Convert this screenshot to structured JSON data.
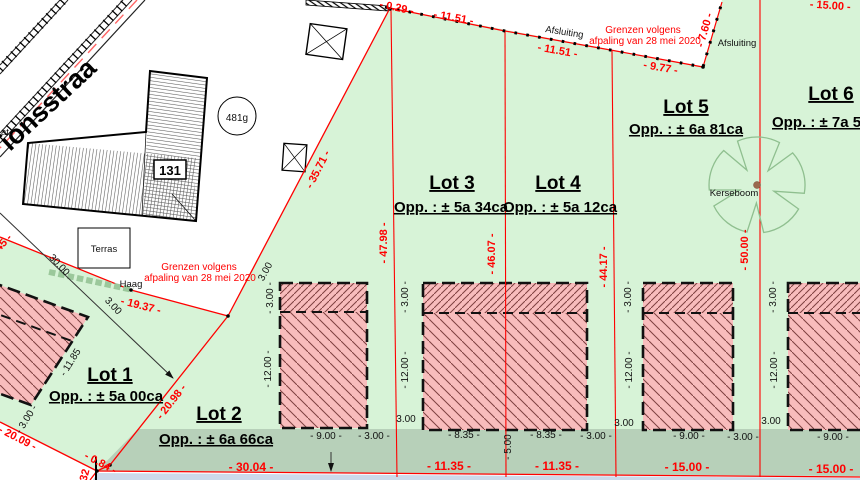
{
  "colors": {
    "lot_green": "#d7f3d7",
    "strip_green": "#b7d0b9",
    "building_pink": "#f8bcbc",
    "hatch_red": "#7d4040",
    "boundary_red": "#ff0000",
    "road_dash_red": "#ff6666",
    "pale_blue_strip": "#ccd9ea",
    "tree_green": "#8fbf8f",
    "trunk_brown": "#9a6a4e"
  },
  "street": {
    "name_fragment": "ionsstraa",
    "edge_fragment": "at."
  },
  "landmarks": {
    "house_number": "131",
    "parcel_id": "481g",
    "terrace": "Terras",
    "hedge": "Haag",
    "tree": "Kerseboom",
    "fence_top": "Afsluiting",
    "fence_right": "Afsluiting"
  },
  "notes": {
    "survey_top_line1": "Grenzen volgens",
    "survey_top_line2": "afpaling van 28 mei 2020",
    "survey_left_line1": "Grenzen volgens",
    "survey_left_line2": "afpaling van 28 mei 2020"
  },
  "lots": [
    {
      "name": "Lot 1",
      "area": "Opp. : ± 5a 00ca"
    },
    {
      "name": "Lot 2",
      "area": "Opp. : ± 6a 66ca"
    },
    {
      "name": "Lot 3",
      "area": "Opp. : ± 5a 34ca"
    },
    {
      "name": "Lot 4",
      "area": "Opp. : ± 5a 12ca"
    },
    {
      "name": "Lot 5",
      "area": "Opp. : ± 6a 81ca"
    },
    {
      "name": "Lot 6",
      "area": "Opp. : ± 7a 5"
    }
  ],
  "dims_red": {
    "seg029": "- 0.29 -",
    "seg1151a": "- 11.51 -",
    "seg1151b": "- 11.51 -",
    "seg977": "- 9.77 -",
    "seg760": "- 7.60 -",
    "seg1500top": "- 15.00 -",
    "seg3571": "- 35.71 -",
    "seg4798": "- 47.98 -",
    "seg4607": "- 46.07 -",
    "seg4417": "- 44.17 -",
    "seg5000": "- 50.00 -",
    "seg45": "45 -",
    "seg1937": "- 19.37 -",
    "seg2098": "- 20.98 -",
    "seg2009": "- 20.09 -",
    "seg084": "- 0.84 -",
    "seg32": "32",
    "seg3004": "- 30.04 -",
    "seg1135a": "- 11.35 -",
    "seg1135b": "- 11.35 -",
    "seg1500a": "- 15.00 -",
    "seg1500b": "- 15.00 -"
  },
  "dims_black": {
    "d3000": "30.00",
    "d300arrow": "3.00",
    "d1185": "- 11.85",
    "d300lot1": "- 3.00 -",
    "a_corner": "3.00",
    "a_front": "- 3.00 -",
    "a_depth": "- 12.00 -",
    "a_w": "- 9.00 -",
    "a_gapr": "- 3.00 -",
    "b_gap": "3.00",
    "b_front": "- 3.00 -",
    "b_depth": "- 12.00 -",
    "b_w1": "- 8.35 -",
    "b_w2": "- 8.35 -",
    "b_mid": "- 5.00 -",
    "b_gapr": "- 3.00 -",
    "c_gap": "3.00",
    "c_front": "- 3.00 -",
    "c_depth": "- 12.00 -",
    "c_w": "- 9.00 -",
    "c_gapr": "- 3.00 -",
    "d_gap": "3.00",
    "d_front": "- 3.00 -",
    "d_depth": "- 12.00 -",
    "d_w": "- 9.00 -"
  }
}
